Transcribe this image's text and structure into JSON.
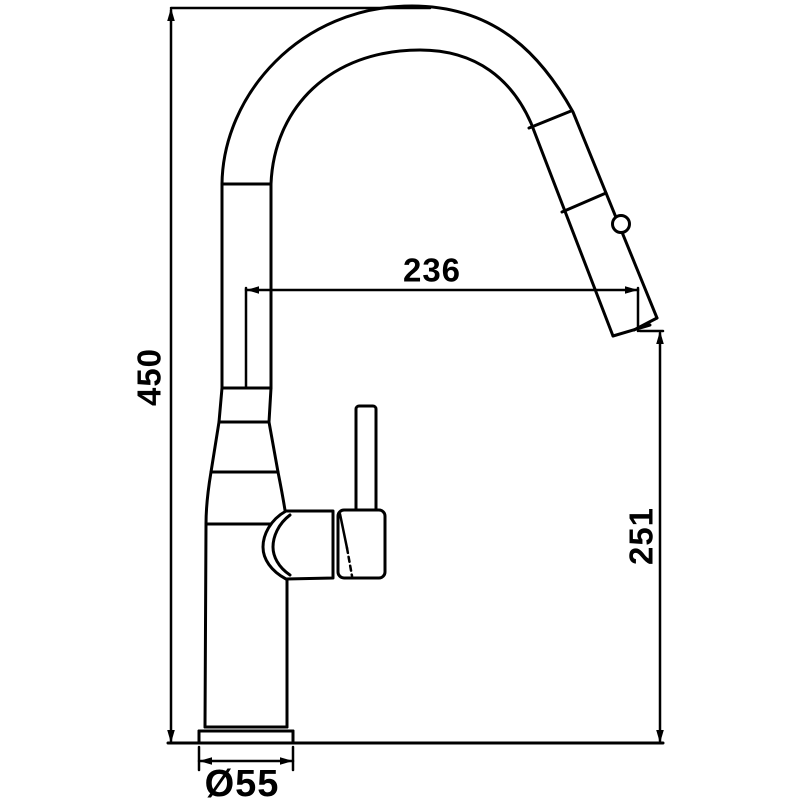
{
  "canvas": {
    "background": "#ffffff",
    "line_color": "#000000"
  },
  "dimensions": {
    "overall_height": {
      "label": "450"
    },
    "spout_reach": {
      "label": "236"
    },
    "outlet_height": {
      "label": "251"
    },
    "base_diameter": {
      "label": "Ø55"
    }
  }
}
